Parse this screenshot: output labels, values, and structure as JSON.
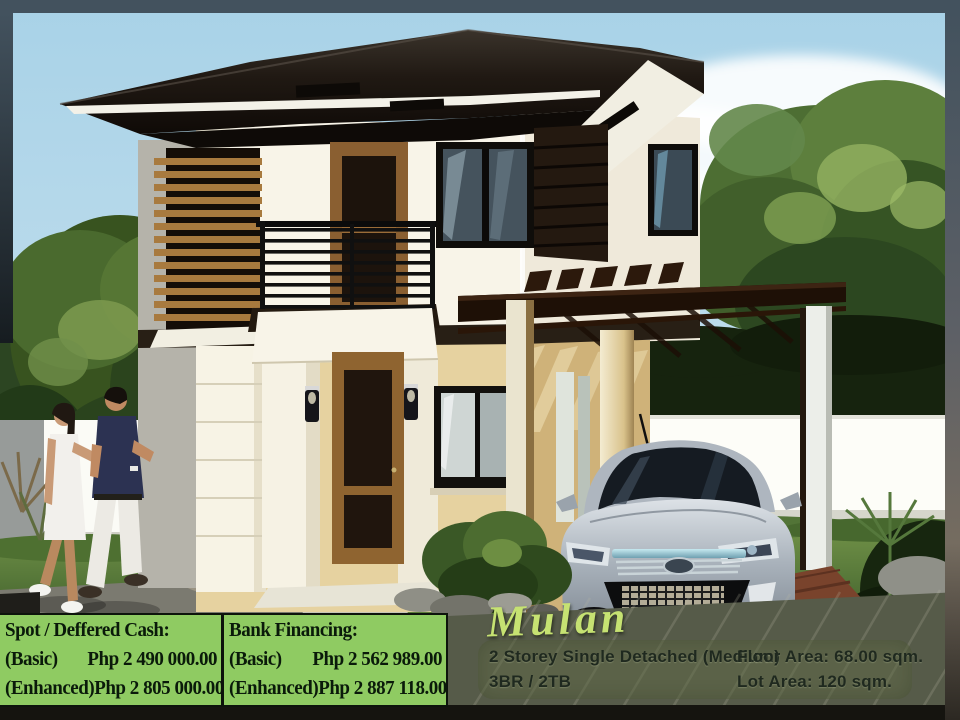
{
  "pricing_banner": {
    "background_color": "#8fcb62",
    "text_color": "#0a1a0a",
    "panels": [
      {
        "heading": "Spot / Deffered Cash:",
        "rows": [
          {
            "label": "(Basic)",
            "value": "Php 2 490 000.00"
          },
          {
            "label": "(Enhanced)",
            "value": "Php 2 805 000.00"
          }
        ]
      },
      {
        "heading": "Bank Financing:",
        "rows": [
          {
            "label": "(Basic)",
            "value": "Php 2 562 989.00"
          },
          {
            "label": "(Enhanced)",
            "value": "Php 2 887 118.00"
          }
        ]
      }
    ]
  },
  "model_info": {
    "name": "Mulan",
    "name_color": "#c6e272",
    "type": "2 Storey Single Detached (Medium)",
    "rooms": "3BR / 2TB",
    "floor_area": "Floor Area: 68.00 sqm.",
    "lot_area": "Lot Area: 120 sqm."
  },
  "scene_colors": {
    "sky": "#b7d9e9",
    "roof": "#1a130d",
    "upper_wall": "#f8f4e8",
    "lower_wall": "#e6d2a0",
    "wood_louver": "#a87a3e",
    "lawn": "#5f8139",
    "fence": "#fbfbf6",
    "car_silver": "#aeb6bf",
    "frame": "#43525e"
  }
}
